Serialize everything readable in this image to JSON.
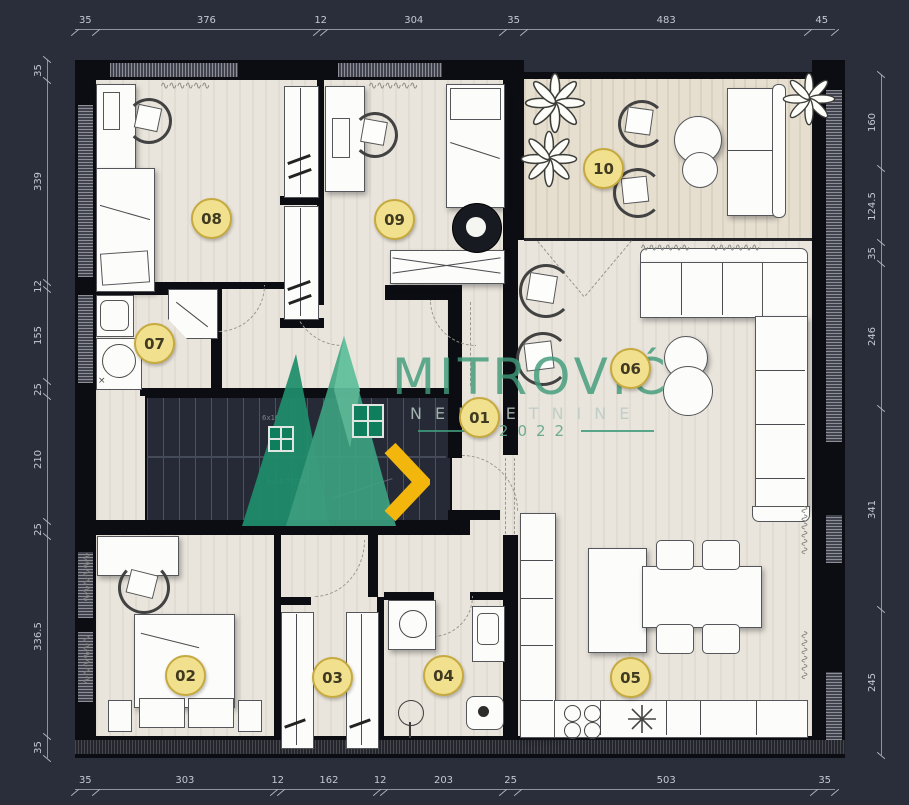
{
  "watermark": {
    "brand": "MITROVIĆ",
    "subtitle": "NEKRETNINE",
    "year": "2022"
  },
  "dimensions": {
    "top": [
      "35",
      "376",
      "12",
      "304",
      "35",
      "483",
      "45"
    ],
    "bottom": [
      "35",
      "303",
      "12",
      "162",
      "12",
      "203",
      "25",
      "503",
      "35"
    ],
    "left": [
      "35",
      "339",
      "12",
      "155",
      "25",
      "210",
      "25",
      "336.5",
      "35"
    ],
    "right": [
      "160",
      "124.5",
      "35",
      "246",
      "341",
      "245"
    ]
  },
  "rooms": [
    {
      "id": "01"
    },
    {
      "id": "02"
    },
    {
      "id": "03"
    },
    {
      "id": "04"
    },
    {
      "id": "05"
    },
    {
      "id": "06"
    },
    {
      "id": "07"
    },
    {
      "id": "08"
    },
    {
      "id": "09"
    },
    {
      "id": "10"
    }
  ],
  "stairs": {
    "upper_flight": "6x16",
    "lower_flight": "9x15.72/29"
  },
  "icons": {
    "entrance_arrow": "❯",
    "curtain": "∿∿∿∿∿∿",
    "sink_star": "✳",
    "drain": "×"
  },
  "colors": {
    "background": "#2a2d3a",
    "wall": "#0c0d12",
    "floor": "#e9e5dc",
    "terrace_floor": "#e6dfd0",
    "accent_teal": "#3d9c7c",
    "badge_fill": "#f1e18e",
    "badge_border": "#c6a93f",
    "entrance_yellow": "#f2b60d"
  }
}
